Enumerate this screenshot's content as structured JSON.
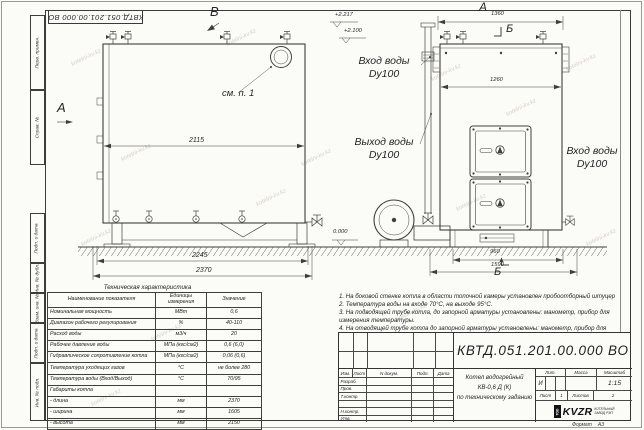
{
  "sheet": {
    "stamp_top": "КВТД.051.201.00.000 ВО",
    "format_label": "Формат",
    "format_value": "А3",
    "watermark": "kotelni-kv.kz"
  },
  "sidebar": {
    "labels": [
      "Перв. примен.",
      "Справ. №",
      "Подп. и дата",
      "Инв. № дубл.",
      "Взам. инв. №",
      "Подп. и дата",
      "Инв. № подл."
    ]
  },
  "drawing": {
    "view_b": "В",
    "view_a": "А",
    "see_note": "см. п. 1",
    "elev_1": "+2.217",
    "elev_2": "+2.100",
    "elev_zero": "0.000",
    "inlet_left": {
      "line1": "Вход воды",
      "line2": "Dy100"
    },
    "outlet": {
      "line1": "Выход воды",
      "line2": "Dy100"
    },
    "inlet_right": {
      "line1": "Вход воды",
      "line2": "Dy100"
    },
    "view_a_right": "А",
    "view_b_top": "Б",
    "view_b_bottom": "Б",
    "dim_2115": "2115",
    "dim_2245": "2245",
    "dim_2370": "2370",
    "dim_1360": "1360",
    "dim_1260": "1260",
    "dim_960": "960",
    "dim_1590": "1590"
  },
  "spec_table": {
    "title": "Техническая характеристика",
    "headers": [
      "Наименование показателя",
      "Единицы измерения",
      "Значение"
    ],
    "rows": [
      [
        "Номинальная мощность",
        "МВт",
        "0,6"
      ],
      [
        "Диапазон рабочего регулирования",
        "%",
        "40-110"
      ],
      [
        "Расход воды",
        "м3/ч",
        "20"
      ],
      [
        "Рабочее давление воды",
        "МПа (кгс/см2)",
        "0,6 (6,0)"
      ],
      [
        "Гидравлическое сопротивление котла",
        "МПа (кгс/см2)",
        "0,06 (0,6)"
      ],
      [
        "Температура уходящих газов",
        "°С",
        "не более 280"
      ],
      [
        "Температура воды (Вход/Выход)",
        "°С",
        "70/95"
      ],
      [
        "Габариты котла",
        "",
        ""
      ],
      [
        "- длина",
        "мм",
        "2370"
      ],
      [
        "- ширина",
        "мм",
        "1605"
      ],
      [
        "- высота",
        "мм",
        "2150"
      ]
    ]
  },
  "notes": [
    "1. На боковой стенке котла в области топочной камеры установлен пробоотборный штуцер",
    "2. Температура воды на входе 70°С, на выходе 95°С.",
    "3. На подводящей трубе котла, до запорной арматуры установлены: манометр, прибор для измерения температуры.",
    "4. На отводящей трубе котла до запорной арматуры установлены: манометр, прибор для измерения температуры и два предохранительных клапана Dy не менее 40 мм.",
    "5. Остальные технические требования по ОСТ 108.030.133-84."
  ],
  "title_block": {
    "doc_number": "КВТД.051.201.00.000 ВО",
    "rev_headers": [
      "Изм.",
      "Лист",
      "N докум.",
      "Подп.",
      "Дата"
    ],
    "sign_rows": [
      "Разраб.",
      "Пров.",
      "Т.контр.",
      "",
      "Н.контр.",
      "Утв."
    ],
    "product_lines": [
      "Котел водогрейный",
      "КВ-0,6 Д (К)",
      "по техническому заданию"
    ],
    "lit_label": "Лит.",
    "mass_label": "Масса",
    "scale_label": "Масштаб",
    "lit_value": "И",
    "scale_value": "1:15",
    "sheet_label": "Лист",
    "sheet_value": "1",
    "sheets_label": "Листов",
    "sheets_value": "2",
    "company": {
      "prefix": "ТОО",
      "logo": "KVZR",
      "line1": "КОТЕЛЬНЫЙ",
      "line2": "ЗАВОД РЭП"
    }
  }
}
